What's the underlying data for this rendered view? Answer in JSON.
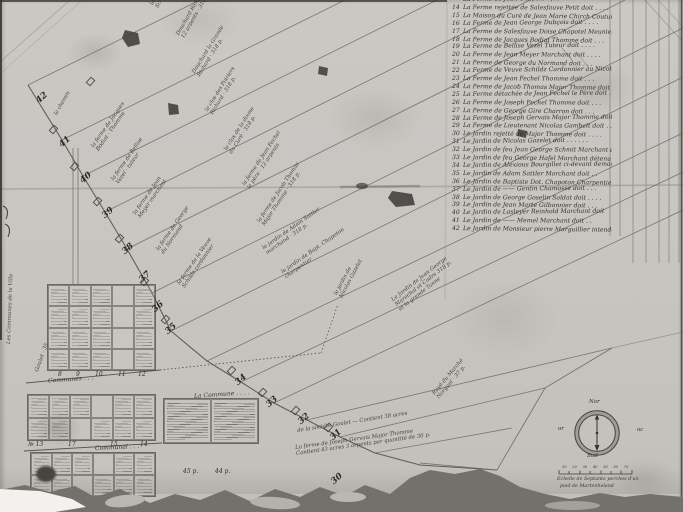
{
  "artifact": {
    "kind": "plan terrier manuscrit",
    "language": "français"
  },
  "colors": {
    "paper": "#c9c7c1",
    "ink": "#2e2c28",
    "ink_faint": "#6e6c67",
    "crease": "#a5a39d",
    "torn_shadow": "#73716c",
    "white_backing": "#f2f1ee"
  },
  "register": {
    "entries": [
      {
        "n": "",
        "text": "La Ferme de Jean Chapoton fils doit . . . ."
      },
      {
        "n": "14",
        "text": "La Ferme rejettée de Salesfauve Petit doit . . . ."
      },
      {
        "n": "15",
        "text": "La Maison du Curé de Jean Marie Chirch Couturier doit"
      },
      {
        "n": "16",
        "text": "La Ferme de Jean George Dubçois doit . . . ."
      },
      {
        "n": "17",
        "text": "La Ferme de Salesfauve Doise Chapotel Meunier doit"
      },
      {
        "n": "18",
        "text": "La Ferme de Jacques Bodiat Thomme doit . . ."
      },
      {
        "n": "19",
        "text": "La Ferme de Bellise Vezel Tuteur doit . . . ."
      },
      {
        "n": "20",
        "text": "La Ferme de Jean Meyer Marchant doit . . . ."
      },
      {
        "n": "21",
        "text": "La Ferme de George du Normand doit . . ."
      },
      {
        "n": "22",
        "text": "La Ferme de Veuve Schildz Cordonnier au Nicolas Gouldt doit"
      },
      {
        "n": "23",
        "text": "La Ferme de Jean Fechel Thomme doit . . ."
      },
      {
        "n": "24",
        "text": "La Ferme de Jacob Thomas Major Thomme doit . . ."
      },
      {
        "n": "25",
        "text": "La Ferme détachée de Jean Fechel le Père doit . . ."
      },
      {
        "n": "26",
        "text": "La Ferme de Joseph Fechel Thomme doit . . ."
      },
      {
        "n": "27",
        "text": "La Ferme de George Gire Charron doit . . ."
      },
      {
        "n": "28",
        "text": "La Ferme de Joseph Gervais Major Thomme doit . . ."
      },
      {
        "n": "29",
        "text": "La Ferme de Lieutenant Nicolas Gambelt doit . . ."
      },
      {
        "n": "30",
        "text": "Le Jardin rejetté de Major Thomme doit . . . ."
      },
      {
        "n": "31",
        "text": "Le Jardin de Nicolas Gazelet doit . . . . . ."
      },
      {
        "n": "32",
        "text": "Le Jardin de feu Jean George Schmit Marchant doit"
      },
      {
        "n": "33",
        "text": "Le Jardin de feu George Hafel Marchant détenu"
      },
      {
        "n": "34",
        "text": "Le Jardin de Alexious Bourgillet ci-devant demandé"
      },
      {
        "n": "35",
        "text": "Le Jardin de Adam Sattler Marchant doit . ."
      },
      {
        "n": "36",
        "text": "Le Jardin de Baptiste Dot. Chapoton Charpentier doit"
      },
      {
        "n": "37",
        "text": "Le Jardin de —— Gentin Chamosse doit . . ."
      },
      {
        "n": "38",
        "text": "Le Jardin de George Goselin Soldat doit . . . ."
      },
      {
        "n": "39",
        "text": "Le Jardin de Jean Marte Gilbonnier doit . . ."
      },
      {
        "n": "40",
        "text": "Le Jardin de Lasleyer Reinhold Marchant doit"
      },
      {
        "n": "41",
        "text": "Le Jardin de —— Memel Marchant doit . ."
      },
      {
        "n": "42",
        "text": "Le Jardin de Monsieur pierre Marguillier intendant"
      }
    ]
  },
  "road_plot_numbers": [
    {
      "n": "42",
      "x": 36,
      "y": 93
    },
    {
      "n": "41",
      "x": 59,
      "y": 137
    },
    {
      "n": "40",
      "x": 80,
      "y": 173
    },
    {
      "n": "39",
      "x": 102,
      "y": 208
    },
    {
      "n": "38",
      "x": 122,
      "y": 244
    },
    {
      "n": "37",
      "x": 139,
      "y": 272
    },
    {
      "n": "36",
      "x": 152,
      "y": 302
    },
    {
      "n": "35",
      "x": 165,
      "y": 324
    },
    {
      "n": "34",
      "x": 235,
      "y": 375
    },
    {
      "n": "33",
      "x": 266,
      "y": 397
    },
    {
      "n": "32",
      "x": 298,
      "y": 414
    },
    {
      "n": "31",
      "x": 330,
      "y": 430
    },
    {
      "n": "30",
      "x": 331,
      "y": 474
    }
  ],
  "farm_labels": [
    {
      "x": 150,
      "y": 4,
      "a": -62,
      "lines": [
        "la ferme du Sr Jean George",
        "Schmit marchant · 318 p."
      ]
    },
    {
      "x": 176,
      "y": 34,
      "a": -60,
      "lines": [
        "Douchard Richard",
        "12 arpents · 318 p."
      ]
    },
    {
      "x": 192,
      "y": 72,
      "a": -58,
      "lines": [
        "Douchard la Grande",
        "Richard · 318 p."
      ]
    },
    {
      "x": 205,
      "y": 110,
      "a": -58,
      "lines": [
        "le clos des Poiriers",
        "Richard · 318 p."
      ]
    },
    {
      "x": 91,
      "y": 146,
      "a": -55,
      "lines": [
        "la ferme de Jacques",
        "Bodiat · Thomme"
      ]
    },
    {
      "x": 111,
      "y": 179,
      "a": -55,
      "lines": [
        "la ferme de Bellise",
        "Vezel · tuteur"
      ]
    },
    {
      "x": 133,
      "y": 213,
      "a": -55,
      "lines": [
        "la ferme de Jean",
        "Meyer marchant"
      ]
    },
    {
      "x": 156,
      "y": 249,
      "a": -55,
      "lines": [
        "la ferme de George",
        "du Normand"
      ]
    },
    {
      "x": 177,
      "y": 283,
      "a": -55,
      "lines": [
        "la ferme de la Veuve",
        "Schildz cordonnier"
      ]
    },
    {
      "x": 224,
      "y": 149,
      "a": -57,
      "lines": [
        "le clos de la dixme",
        "du Curé · 318 p."
      ]
    },
    {
      "x": 242,
      "y": 184,
      "a": -56,
      "lines": [
        "la ferme de Jean Fechel",
        "le père · 12 arpents"
      ]
    },
    {
      "x": 257,
      "y": 221,
      "a": -56,
      "lines": [
        "la ferme de Jacob Thomas",
        "Major Thomme · 318 p."
      ]
    },
    {
      "x": 262,
      "y": 247,
      "a": -35,
      "lines": [
        "le jardin de Adam Sattler",
        "marchand · 318 p."
      ]
    },
    {
      "x": 281,
      "y": 271,
      "a": -35,
      "lines": [
        "le jardin de Bapt. Chapoton",
        "charpentier"
      ]
    },
    {
      "x": 334,
      "y": 294,
      "a": -62,
      "lines": [
        "le jardin de",
        "Nicolas Gazelet"
      ]
    },
    {
      "x": 391,
      "y": 299,
      "a": -38,
      "lines": [
        "Le Jardin de Jean George",
        "Marechal et Cadre 318 p.",
        "et la grande Tanne"
      ]
    },
    {
      "x": 432,
      "y": 393,
      "a": -50,
      "lines": [
        "Rayé du Marché",
        "Norguel · 37 p."
      ]
    },
    {
      "x": 297,
      "y": 429,
      "a": -9,
      "lines": [
        "de la société Goulet — Contient 38 acres"
      ]
    },
    {
      "x": 295,
      "y": 446,
      "a": -8,
      "lines": [
        "La ferme de Joseph Gervais Major Thomme",
        "Contient 43 acres 3 arpents par quantité de 30 p."
      ]
    },
    {
      "x": 413,
      "y": 483,
      "a": -4,
      "lines": [
        "Chemin du marais de la Rigole"
      ]
    },
    {
      "x": 7,
      "y": 344,
      "a": -88,
      "lines": [
        "Les Communes de la Ville"
      ]
    },
    {
      "x": 35,
      "y": 371,
      "a": -70,
      "lines": [
        "Goulet · 35"
      ]
    },
    {
      "x": 54,
      "y": 114,
      "a": -60,
      "lines": [
        "le chemin"
      ]
    }
  ],
  "lot_grids": {
    "band_a_numbers": [
      {
        "t": "8",
        "x": 58
      },
      {
        "t": "9",
        "x": 76
      },
      {
        "t": "10",
        "x": 95
      },
      {
        "t": "11",
        "x": 118
      },
      {
        "t": "12",
        "x": 138
      }
    ],
    "band_a_caption": "Communes . . .",
    "band_b_numbers": [
      {
        "t": "№ 13",
        "x": 28
      },
      {
        "t": "17",
        "x": 68
      },
      {
        "t": "15",
        "x": 110
      },
      {
        "t": "14",
        "x": 140
      }
    ],
    "band_b_caption": "Communal . . .",
    "annex_notes": [
      {
        "t": "45 p.",
        "x": 183
      },
      {
        "t": "44 p.",
        "x": 215
      }
    ],
    "commune_label": "La Commune . . . ."
  },
  "compass": {
    "north": "Nor",
    "south": "Sud",
    "west": "or",
    "east": "oc"
  },
  "scale_bar": {
    "ticks": [
      "10",
      "20",
      "30",
      "40",
      "50",
      "60",
      "70"
    ],
    "line1": "Echelle de Septante perches d'un",
    "line2": "pied de Martenheland"
  }
}
